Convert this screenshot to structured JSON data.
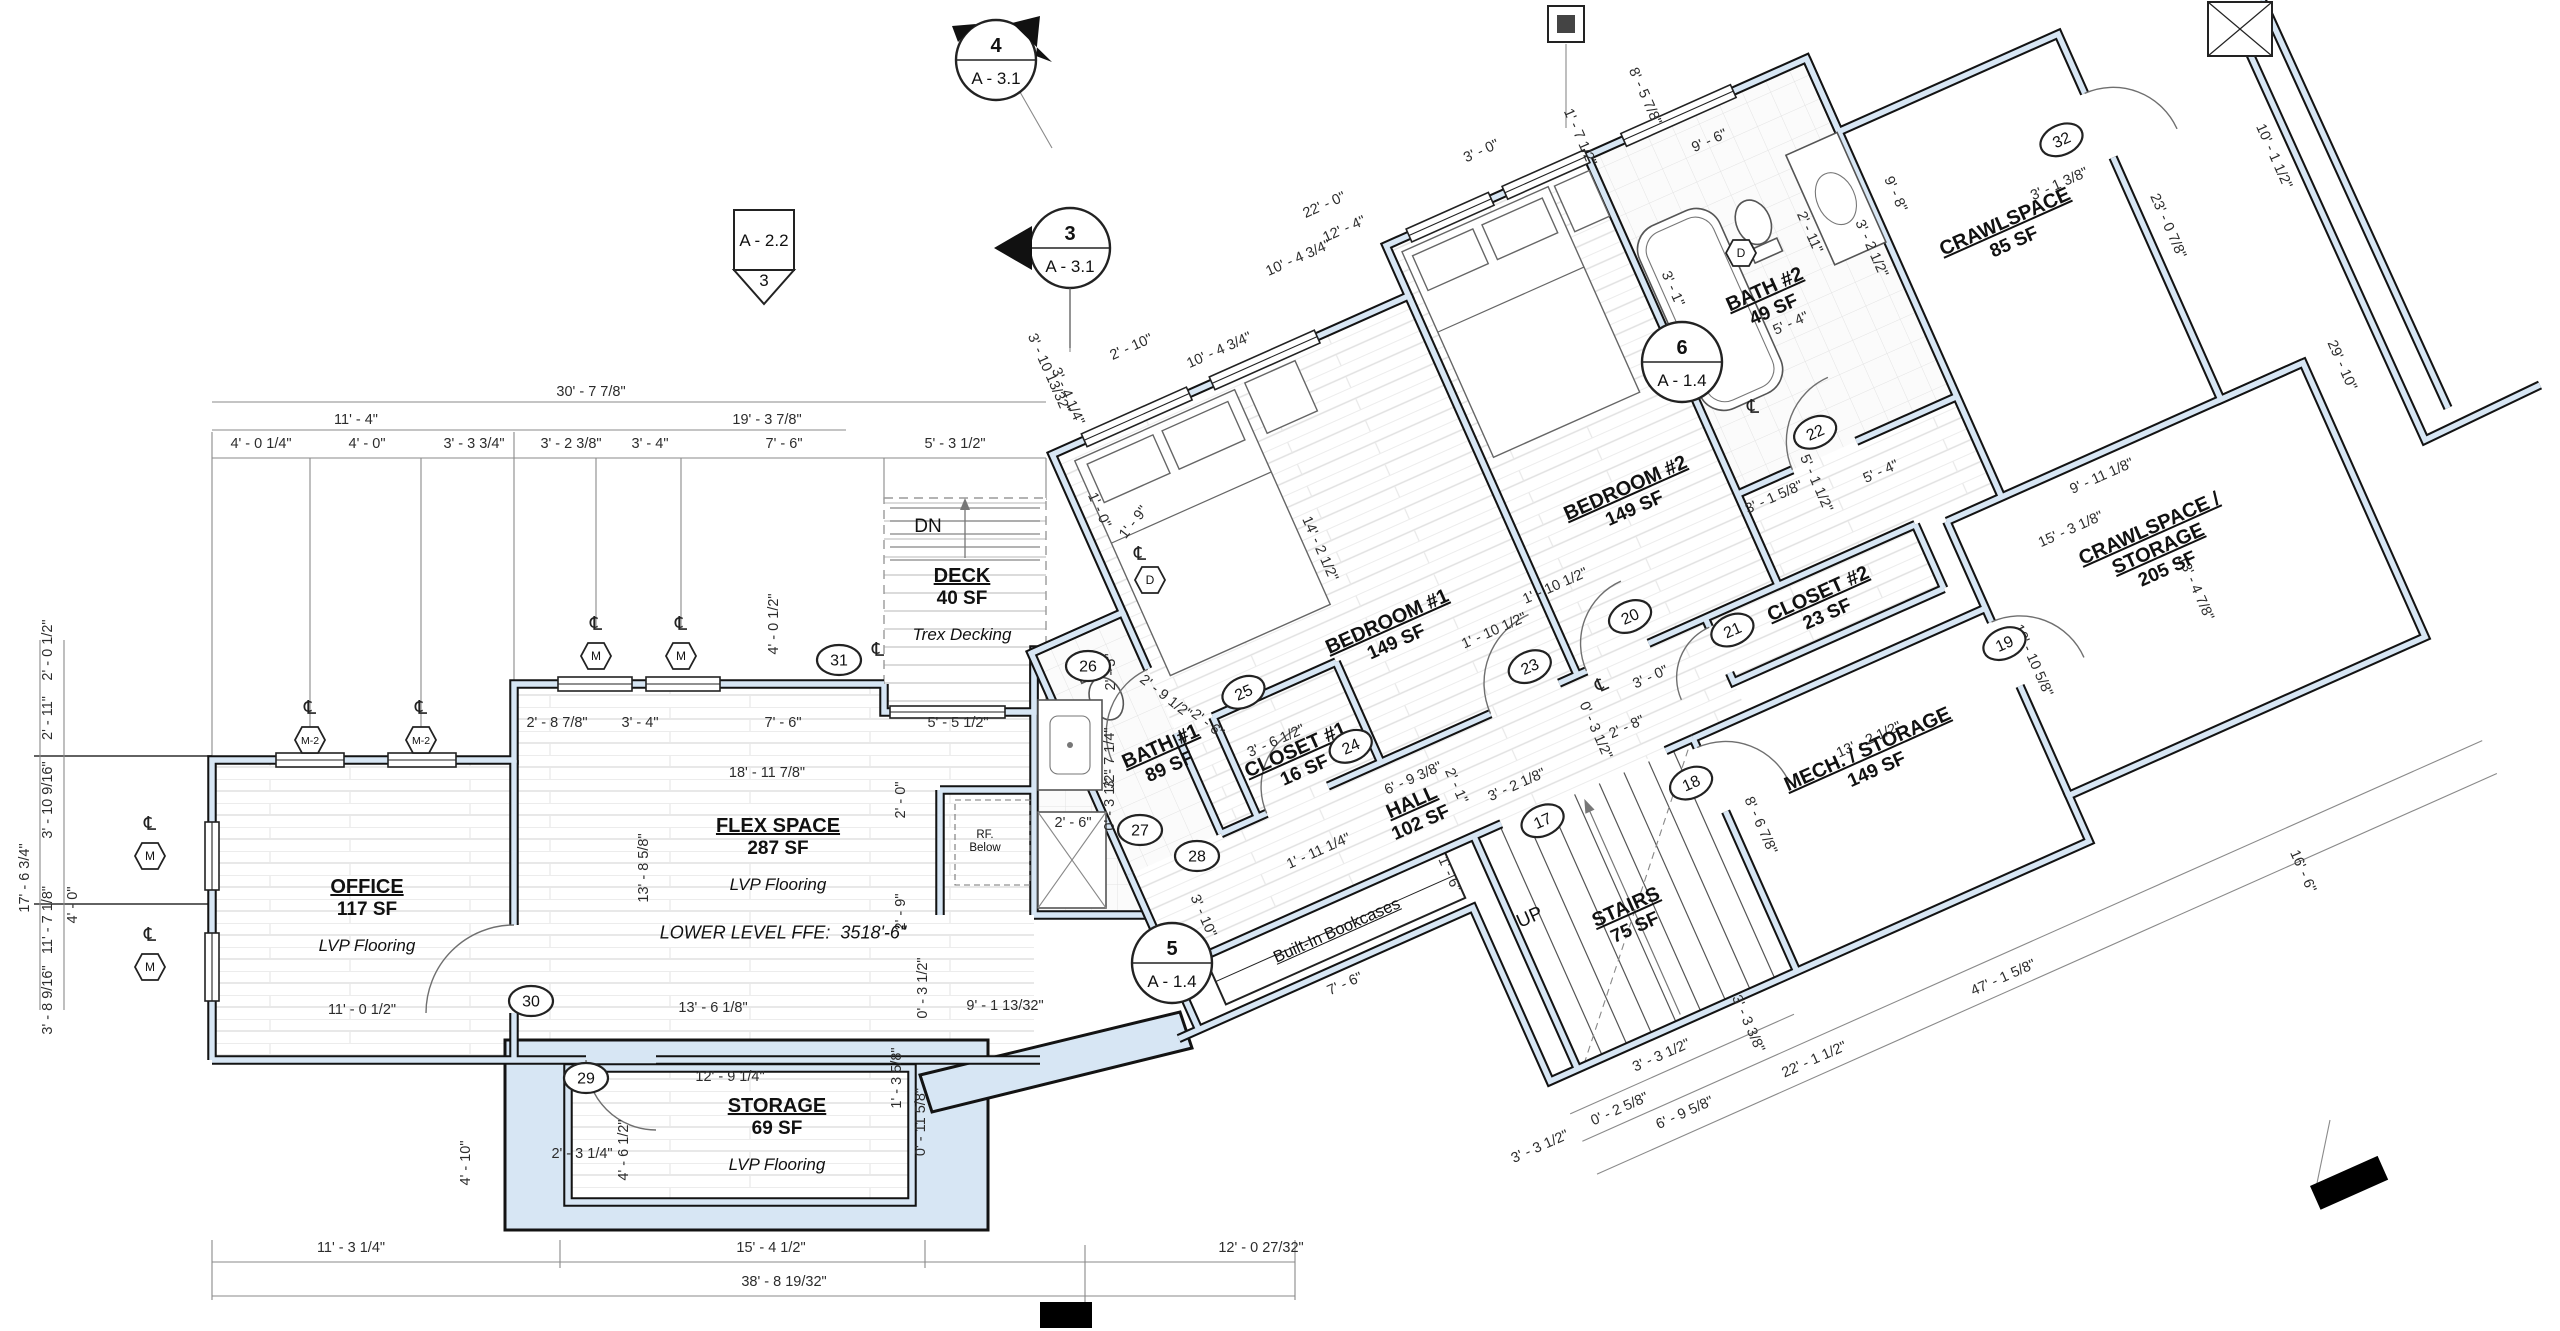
{
  "drawing": {
    "type": "architectural-floor-plan",
    "level": "Lower Level",
    "colors": {
      "wall_fill": "#d7e6f4",
      "wall_line": "#131313",
      "dim_text": "#2c2c2c",
      "paper": "#ffffff"
    },
    "cl_glyph": "℄",
    "texts": {
      "dn": "DN",
      "up": "UP",
      "rf_1": "RF.",
      "rf_2": "Below",
      "bookcases": "Built-In Bookcases",
      "ffe": "LOWER LEVEL FFE:  3518'-6\""
    },
    "rooms": [
      {
        "id": "office",
        "name": "OFFICE",
        "area": "117 SF",
        "note": "LVP Flooring",
        "f": "s",
        "x": 367,
        "y": 893,
        "r": 0
      },
      {
        "id": "flex-space",
        "name": "FLEX SPACE",
        "area": "287 SF",
        "note": "LVP Flooring",
        "f": "s",
        "x": 778,
        "y": 832,
        "r": 0
      },
      {
        "id": "storage",
        "name": "STORAGE",
        "area": "69 SF",
        "note": "LVP Flooring",
        "f": "s",
        "x": 777,
        "y": 1112,
        "r": 0
      },
      {
        "id": "deck",
        "name": "DECK",
        "area": "40 SF",
        "note": "Trex Decking",
        "f": "s",
        "x": 962,
        "y": 582,
        "r": 0
      },
      {
        "id": "bath-1",
        "name": "BATH #1",
        "area": "89 SF",
        "f": "s",
        "x": 1163,
        "y": 752,
        "r": -24
      },
      {
        "id": "closet-1",
        "name": "CLOSET #1",
        "area": "16 SF",
        "f": "w",
        "x": 1352,
        "y": 830,
        "r": 0
      },
      {
        "id": "bedroom-1",
        "name": "BEDROOM #1",
        "area": "149 SF",
        "f": "w",
        "x": 1488,
        "y": 750,
        "r": 0
      },
      {
        "id": "bedroom-2",
        "name": "BEDROOM #2",
        "area": "149 SF",
        "f": "w",
        "x": 1760,
        "y": 725,
        "r": 0
      },
      {
        "id": "bath-2",
        "name": "BATH #2",
        "area": "49 SF",
        "f": "w",
        "x": 1968,
        "y": 600,
        "r": 0
      },
      {
        "id": "closet-2",
        "name": "CLOSET #2",
        "area": "23 SF",
        "f": "w",
        "x": 1893,
        "y": 900,
        "r": 0
      },
      {
        "id": "hall",
        "name": "HALL",
        "area": "102 SF",
        "f": "w",
        "x": 1437,
        "y": 925,
        "r": 0
      },
      {
        "id": "mech-storage",
        "name": "MECH. / STORAGE",
        "area": "149 SF",
        "f": "w",
        "x": 1875,
        "y": 1062,
        "r": 0
      },
      {
        "id": "stairs",
        "name": "STAIRS",
        "area": "75 SF",
        "f": "w",
        "x": 1590,
        "y": 1108,
        "r": 0
      },
      {
        "id": "crawlspace",
        "name": "CRAWLSPACE",
        "area": "85 SF",
        "f": "w",
        "x": 2215,
        "y": 636,
        "r": 0
      },
      {
        "id": "crawlspace-storage",
        "name": "CRAWLSPACE /",
        "name2": "STORAGE",
        "area": "205 SF",
        "f": "w",
        "x": 2222,
        "y": 975,
        "r": 0
      }
    ],
    "dimensions": [
      {
        "t": "30' - 7 7/8\"",
        "x": 591,
        "y": 396,
        "r": 0,
        "f": "s"
      },
      {
        "t": "11' - 4\"",
        "x": 356,
        "y": 424,
        "r": 0,
        "f": "s"
      },
      {
        "t": "19' - 3 7/8\"",
        "x": 767,
        "y": 424,
        "r": 0,
        "f": "s"
      },
      {
        "t": "4' - 0 1/4\"",
        "x": 261,
        "y": 448,
        "r": 0,
        "f": "s"
      },
      {
        "t": "4' - 0\"",
        "x": 367,
        "y": 448,
        "r": 0,
        "f": "s"
      },
      {
        "t": "3' - 3 3/4\"",
        "x": 474,
        "y": 448,
        "r": 0,
        "f": "s"
      },
      {
        "t": "3' - 2 3/8\"",
        "x": 571,
        "y": 448,
        "r": 0,
        "f": "s"
      },
      {
        "t": "3' - 4\"",
        "x": 650,
        "y": 448,
        "r": 0,
        "f": "s"
      },
      {
        "t": "7' - 6\"",
        "x": 784,
        "y": 448,
        "r": 0,
        "f": "s"
      },
      {
        "t": "5' - 3 1/2\"",
        "x": 955,
        "y": 448,
        "r": 0,
        "f": "s"
      },
      {
        "t": "17' - 6 3/4\"",
        "x": 29,
        "y": 878,
        "r": -90,
        "f": "s"
      },
      {
        "t": "2' - 0 1/2\"",
        "x": 52,
        "y": 650,
        "r": -90,
        "f": "s"
      },
      {
        "t": "2' - 11\"",
        "x": 52,
        "y": 718,
        "r": -90,
        "f": "s"
      },
      {
        "t": "3' - 10 9/16\"",
        "x": 52,
        "y": 800,
        "r": -90,
        "f": "s"
      },
      {
        "t": "11' - 7 1/8\"",
        "x": 52,
        "y": 920,
        "r": -90,
        "f": "s"
      },
      {
        "t": "3' - 8 9/16\"",
        "x": 52,
        "y": 1000,
        "r": -90,
        "f": "s"
      },
      {
        "t": "4' - 0\"",
        "x": 77,
        "y": 905,
        "r": -90,
        "f": "s"
      },
      {
        "t": "2' - 8 7/8\"",
        "x": 557,
        "y": 727,
        "r": 0,
        "f": "s"
      },
      {
        "t": "3' - 4\"",
        "x": 640,
        "y": 727,
        "r": 0,
        "f": "s"
      },
      {
        "t": "7' - 6\"",
        "x": 783,
        "y": 727,
        "r": 0,
        "f": "s"
      },
      {
        "t": "18' - 11 7/8\"",
        "x": 767,
        "y": 777,
        "r": 0,
        "f": "s"
      },
      {
        "t": "13' - 8 5/8\"",
        "x": 648,
        "y": 868,
        "r": -90,
        "f": "s"
      },
      {
        "t": "2' - 0\"",
        "x": 905,
        "y": 800,
        "r": -90,
        "f": "s"
      },
      {
        "t": "2' - 9\"",
        "x": 905,
        "y": 912,
        "r": -90,
        "f": "s"
      },
      {
        "t": "0' - 3 1/2\"",
        "x": 927,
        "y": 988,
        "r": -90,
        "f": "s"
      },
      {
        "t": "9' - 1 13/32\"",
        "x": 1005,
        "y": 1010,
        "r": 0,
        "f": "s"
      },
      {
        "t": "13' - 6 1/8\"",
        "x": 713,
        "y": 1012,
        "r": 0,
        "f": "s"
      },
      {
        "t": "11' - 0 1/2\"",
        "x": 362,
        "y": 1014,
        "r": 0,
        "f": "s"
      },
      {
        "t": "4' - 0 1/2\"",
        "x": 778,
        "y": 624,
        "r": -90,
        "f": "s"
      },
      {
        "t": "1' - 9\"",
        "x": 1137,
        "y": 525,
        "r": -52,
        "f": "s"
      },
      {
        "t": "12' - 9 1/4\"",
        "x": 730,
        "y": 1081,
        "r": 0,
        "f": "s"
      },
      {
        "t": "4' - 6 1/2\"",
        "x": 628,
        "y": 1150,
        "r": -90,
        "f": "s"
      },
      {
        "t": "2' - 3 1/4\"",
        "x": 582,
        "y": 1158,
        "r": 0,
        "f": "s"
      },
      {
        "t": "4' - 10\"",
        "x": 470,
        "y": 1163,
        "r": -90,
        "f": "s"
      },
      {
        "t": "1' - 3 5/8\"",
        "x": 901,
        "y": 1078,
        "r": -90,
        "f": "s"
      },
      {
        "t": "0' - 11 5/8\"",
        "x": 925,
        "y": 1122,
        "r": -90,
        "f": "s"
      },
      {
        "t": "11' - 3 1/4\"",
        "x": 351,
        "y": 1252,
        "r": 0,
        "f": "s"
      },
      {
        "t": "15' - 4 1/2\"",
        "x": 771,
        "y": 1252,
        "r": 0,
        "f": "s"
      },
      {
        "t": "12' - 0 27/32\"",
        "x": 1261,
        "y": 1252,
        "r": 0,
        "f": "s"
      },
      {
        "t": "38' - 8 19/32\"",
        "x": 784,
        "y": 1286,
        "r": 0,
        "f": "s"
      },
      {
        "t": "2' - 5\"",
        "x": 1115,
        "y": 672,
        "r": -90,
        "f": "s"
      },
      {
        "t": "2' - 9 1/2\"",
        "x": 1163,
        "y": 700,
        "r": 38,
        "f": "s"
      },
      {
        "t": "2' - 6\"",
        "x": 1205,
        "y": 727,
        "r": 38,
        "f": "s"
      },
      {
        "t": "3' - 7 1/4\"",
        "x": 1114,
        "y": 758,
        "r": -90,
        "f": "s"
      },
      {
        "t": "0' - 3 1/2\"",
        "x": 1114,
        "y": 800,
        "r": -90,
        "f": "s"
      },
      {
        "t": "2' - 6\"",
        "x": 1073,
        "y": 827,
        "r": 0,
        "f": "s"
      },
      {
        "t": "5' - 5 1/2\"",
        "x": 958,
        "y": 727,
        "r": 0,
        "f": "s"
      },
      {
        "t": "22' - 0\"",
        "x": 1326,
        "y": 209,
        "r": -24,
        "f": "s"
      },
      {
        "t": "12' - 4\"",
        "x": 1346,
        "y": 233,
        "r": -24,
        "f": "s"
      },
      {
        "t": "3' - 0\"",
        "x": 1483,
        "y": 155,
        "r": -24,
        "f": "s"
      },
      {
        "t": "2' - 10\"",
        "x": 1133,
        "y": 351,
        "r": -24,
        "f": "s"
      },
      {
        "t": "10' - 4 3/4\"",
        "x": 1300,
        "y": 262,
        "r": -24,
        "f": "s"
      },
      {
        "t": "3' - 10 13/32\"",
        "x": 1045,
        "y": 375,
        "r": 66,
        "f": "s"
      },
      {
        "t": "3' - 4 1/4\"",
        "x": 1064,
        "y": 398,
        "r": 66,
        "f": "s"
      },
      {
        "t": "1' - 7 1/2\"",
        "x": 1576,
        "y": 139,
        "r": 66,
        "f": "s"
      },
      {
        "t": "8' - 5 7/8\"",
        "x": 1641,
        "y": 98,
        "r": 66,
        "f": "s"
      },
      {
        "t": "3' - 1 3/8\"",
        "x": 2061,
        "y": 188,
        "r": -24,
        "f": "s"
      },
      {
        "t": "10' - 1 1/2\"",
        "x": 2270,
        "y": 158,
        "r": 66,
        "f": "s"
      },
      {
        "t": "29' - 10\"",
        "x": 2338,
        "y": 367,
        "r": 66,
        "f": "s"
      },
      {
        "t": "16' - 6\"",
        "x": 2299,
        "y": 873,
        "r": 66,
        "f": "s"
      },
      {
        "t": "10' - 4 3/4\"",
        "x": 1445,
        "y": 432,
        "r": 0,
        "f": "w"
      },
      {
        "t": "14' - 2 1/2\"",
        "x": 1452,
        "y": 650,
        "r": 90,
        "f": "w"
      },
      {
        "t": "1' - 0\"",
        "x": 1266,
        "y": 525,
        "r": 90,
        "f": "w"
      },
      {
        "t": "1' - 10 1/2\"",
        "x": 1582,
        "y": 800,
        "r": 0,
        "f": "w"
      },
      {
        "t": "1' - 10 1/2\"",
        "x": 1656,
        "y": 784,
        "r": 0,
        "f": "w"
      },
      {
        "t": "3' - 0\"",
        "x": 1706,
        "y": 906,
        "r": 0,
        "f": "w"
      },
      {
        "t": "6' - 9 3/8\"",
        "x": 1448,
        "y": 902,
        "r": 0,
        "f": "w"
      },
      {
        "t": "1' - 11 1/4\"",
        "x": 1332,
        "y": 930,
        "r": 0,
        "f": "w"
      },
      {
        "t": "3' - 10\"",
        "x": 1196,
        "y": 938,
        "r": 90,
        "f": "w"
      },
      {
        "t": "1' - 6\"",
        "x": 1438,
        "y": 1000,
        "r": 90,
        "f": "w"
      },
      {
        "t": "7' - 6\"",
        "x": 1302,
        "y": 1062,
        "r": 0,
        "f": "w"
      },
      {
        "t": "3' - 6 1/2\"",
        "x": 1338,
        "y": 812,
        "r": 0,
        "f": "w"
      },
      {
        "t": "3' - 2 1/8\"",
        "x": 1540,
        "y": 950,
        "r": 0,
        "f": "w"
      },
      {
        "t": "2' - 1\"",
        "x": 1480,
        "y": 922,
        "r": 90,
        "f": "w"
      },
      {
        "t": "0' - 3 1/2\"",
        "x": 1630,
        "y": 928,
        "r": 90,
        "f": "w"
      },
      {
        "t": "2' - 8\"",
        "x": 1664,
        "y": 942,
        "r": 0,
        "f": "w"
      },
      {
        "t": "13' - 2 1/2\"",
        "x": 1880,
        "y": 1052,
        "r": 0,
        "f": "w"
      },
      {
        "t": "8' - 6 7/8\"",
        "x": 1742,
        "y": 1082,
        "r": 90,
        "f": "w"
      },
      {
        "t": "10' - 10 5/8\"",
        "x": 2058,
        "y": 1042,
        "r": 90,
        "f": "w"
      },
      {
        "t": "3' - 3 1/2\"",
        "x": 1562,
        "y": 1256,
        "r": 0,
        "f": "w"
      },
      {
        "t": "3' - 3 3/8\"",
        "x": 1650,
        "y": 1258,
        "r": 90,
        "f": "w"
      },
      {
        "t": "0' - 2 5/8\"",
        "x": 1502,
        "y": 1288,
        "r": 0,
        "f": "w"
      },
      {
        "t": "3' - 3 1/2\"",
        "x": 1414,
        "y": 1290,
        "r": 0,
        "f": "w"
      },
      {
        "t": "6' - 9 5/8\"",
        "x": 1560,
        "y": 1318,
        "r": 0,
        "f": "w"
      },
      {
        "t": "22' - 1 1/2\"",
        "x": 1700,
        "y": 1322,
        "r": 0,
        "f": "w"
      },
      {
        "t": "47' - 1 5/8\"",
        "x": 1906,
        "y": 1324,
        "r": 0,
        "f": "w"
      },
      {
        "t": "9' - 6\"",
        "x": 1978,
        "y": 440,
        "r": 0,
        "f": "w"
      },
      {
        "t": "3' - 1\"",
        "x": 1880,
        "y": 556,
        "r": 90,
        "f": "w"
      },
      {
        "t": "2' - 11\"",
        "x": 2028,
        "y": 560,
        "r": 90,
        "f": "w"
      },
      {
        "t": "5' - 4\"",
        "x": 1978,
        "y": 640,
        "r": 0,
        "f": "w"
      },
      {
        "t": "3' - 2 1/2\"",
        "x": 2078,
        "y": 600,
        "r": 90,
        "f": "w"
      },
      {
        "t": "5' - 1 1/2\"",
        "x": 1932,
        "y": 792,
        "r": 90,
        "f": "w"
      },
      {
        "t": "3' - 1 5/8\"",
        "x": 1892,
        "y": 792,
        "r": 0,
        "f": "w"
      },
      {
        "t": "5' - 4\"",
        "x": 2000,
        "y": 812,
        "r": 0,
        "f": "w"
      },
      {
        "t": "9' - 8\"",
        "x": 2122,
        "y": 560,
        "r": 90,
        "f": "w"
      },
      {
        "t": "9' - 11 1/8\"",
        "x": 2200,
        "y": 906,
        "r": 0,
        "f": "w"
      },
      {
        "t": "15' - 3 1/8\"",
        "x": 2150,
        "y": 942,
        "r": 0,
        "f": "w"
      },
      {
        "t": "23' - 0 7/8\"",
        "x": 2358,
        "y": 700,
        "r": 90,
        "f": "w"
      },
      {
        "t": "13' - 4 7/8\"",
        "x": 2236,
        "y": 1042,
        "r": 90,
        "f": "w"
      }
    ],
    "bubble_markers": [
      {
        "n": "17",
        "x": 1549,
        "y": 989,
        "f": "w"
      },
      {
        "n": "18",
        "x": 1700,
        "y": 1015,
        "f": "w"
      },
      {
        "n": "19",
        "x": 2043,
        "y": 1015,
        "f": "w"
      },
      {
        "n": "20",
        "x": 1712,
        "y": 838,
        "f": "w"
      },
      {
        "n": "21",
        "x": 1800,
        "y": 892,
        "f": "w"
      },
      {
        "n": "22",
        "x": 1956,
        "y": 745,
        "f": "w"
      },
      {
        "n": "23",
        "x": 1600,
        "y": 843,
        "f": "w"
      },
      {
        "n": "24",
        "x": 1404,
        "y": 843,
        "f": "w"
      },
      {
        "n": "25",
        "x": 1328,
        "y": 750,
        "f": "w"
      },
      {
        "n": "32",
        "x": 2300,
        "y": 578,
        "f": "w"
      },
      {
        "n": "26",
        "x": 1088,
        "y": 666,
        "f": "s"
      },
      {
        "n": "27",
        "x": 1140,
        "y": 830,
        "f": "s"
      },
      {
        "n": "28",
        "x": 1197,
        "y": 856,
        "f": "s"
      },
      {
        "n": "29",
        "x": 586,
        "y": 1078,
        "f": "s"
      },
      {
        "n": "30",
        "x": 531,
        "y": 1001,
        "f": "s"
      },
      {
        "n": "31",
        "x": 839,
        "y": 660,
        "f": "s"
      }
    ],
    "hex_markers": [
      {
        "t": "M",
        "x": 596,
        "y": 656,
        "f": "s"
      },
      {
        "t": "M",
        "x": 681,
        "y": 656,
        "f": "s"
      },
      {
        "t": "M",
        "x": 150,
        "y": 856,
        "f": "s"
      },
      {
        "t": "M",
        "x": 150,
        "y": 967,
        "f": "s"
      },
      {
        "t": "M-2",
        "x": 310,
        "y": 740,
        "f": "s"
      },
      {
        "t": "M-2",
        "x": 421,
        "y": 740,
        "f": "s"
      },
      {
        "t": "D",
        "x": 1150,
        "y": 580,
        "f": "s"
      },
      {
        "t": "D",
        "x": 1741,
        "y": 253,
        "f": "s"
      }
    ],
    "cl_symbols": [
      {
        "x": 596,
        "y": 630,
        "f": "s"
      },
      {
        "x": 681,
        "y": 630,
        "f": "s"
      },
      {
        "x": 310,
        "y": 714,
        "f": "s"
      },
      {
        "x": 421,
        "y": 714,
        "f": "s"
      },
      {
        "x": 150,
        "y": 830,
        "f": "s"
      },
      {
        "x": 150,
        "y": 941,
        "f": "s"
      },
      {
        "x": 878,
        "y": 656,
        "f": "s"
      },
      {
        "x": 1140,
        "y": 560,
        "f": "s"
      },
      {
        "x": 1753,
        "y": 413,
        "f": "s"
      },
      {
        "x": 1658,
        "y": 895,
        "f": "w"
      }
    ],
    "section_markers": [
      {
        "type": "section-circle",
        "num": "4",
        "sheet": "A - 3.1",
        "x": 996,
        "y": 60,
        "dir": "se"
      },
      {
        "type": "section-circle",
        "num": "3",
        "sheet": "A - 3.1",
        "x": 1070,
        "y": 248,
        "dir": "w"
      },
      {
        "type": "elev-square",
        "num": "3",
        "sheet": "A - 2.2",
        "x": 764,
        "y": 240
      },
      {
        "type": "detail-circle",
        "num": "6",
        "sheet": "A - 1.4",
        "x": 1682,
        "y": 362
      },
      {
        "type": "detail-circle",
        "num": "5",
        "sheet": "A - 1.4",
        "x": 1172,
        "y": 963
      }
    ]
  }
}
